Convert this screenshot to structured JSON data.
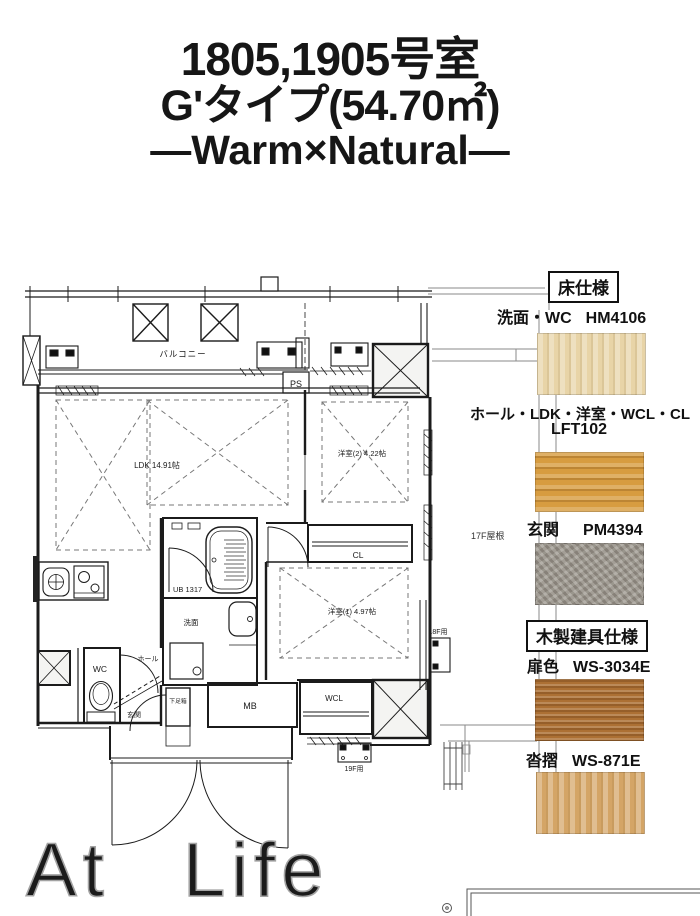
{
  "title": {
    "room_numbers": "1805,1905号室",
    "type_line": "G'タイプ(54.70㎡)",
    "theme_line": "―Warm×Natural―"
  },
  "floor_plan": {
    "labels": {
      "balcony": "バルコニー",
      "ps": "PS",
      "ldk": "LDK 14.91帖",
      "western_room_2": "洋室(2) 4.22帖",
      "western_room_1": "洋室(1) 4.97帖",
      "closet": "CL",
      "unit_bath": "UB 1317",
      "washroom": "洗面",
      "wc": "WC",
      "hall": "ホール",
      "entrance": "玄関",
      "shoe_cabinet": "下足箱",
      "meter_box": "MB",
      "walk_in_closet": "WCL",
      "roof_17f": "17F屋根",
      "for_18f": "18F用",
      "for_19f": "19F用"
    }
  },
  "finish_specs": {
    "floor_section": {
      "heading": "床仕様",
      "items": [
        {
          "areas": "洗面・WC",
          "code": "HM4106",
          "swatch_color": "#e8d4a7"
        },
        {
          "areas": "ホール・LDK・洋室・WCL・CL",
          "code": "LFT102",
          "swatch_color": "#d79c40"
        },
        {
          "areas": "玄関",
          "code": "PM4394",
          "swatch_color": "#9a948a"
        }
      ]
    },
    "fixture_section": {
      "heading": "木製建具仕様",
      "items": [
        {
          "areas": "扉色",
          "code": "WS-3034E",
          "swatch_color": "#ac7034"
        },
        {
          "areas": "沓摺",
          "code": "WS-871E",
          "swatch_color": "#d4a566"
        }
      ]
    }
  },
  "watermark": {
    "word1": "At",
    "word2": "Life"
  }
}
